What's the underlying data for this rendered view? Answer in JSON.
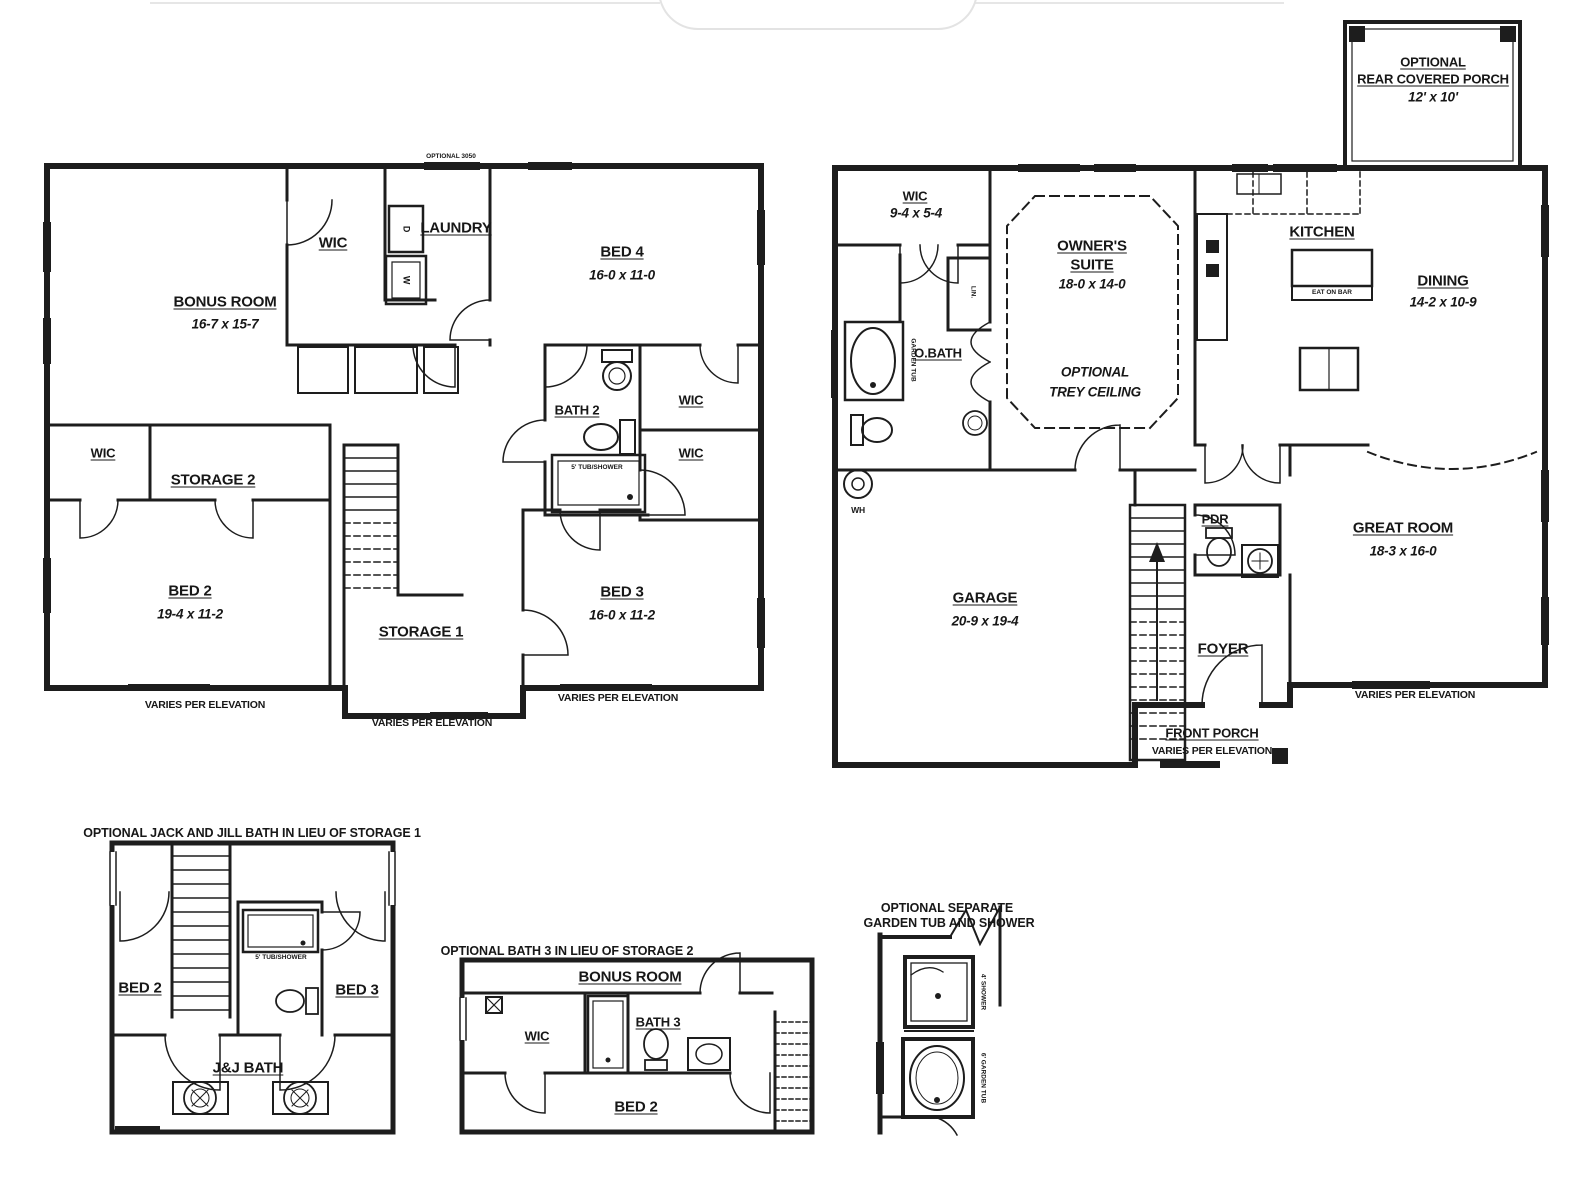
{
  "sf": {
    "opt_note": "OPTIONAL 3050",
    "bonus": "BONUS ROOM",
    "bonus_dim": "16-7 x 15-7",
    "wic": "WIC",
    "laundry": "LAUNDRY",
    "dryer": "D",
    "washer": "W",
    "bed4": "BED 4",
    "bed4_dim": "16-0 x 11-0",
    "bath2": "BATH 2",
    "tub_note": "5' TUB/SHOWER",
    "wic_r1": "WIC",
    "wic_r2": "WIC",
    "wic_l": "WIC",
    "storage2": "STORAGE 2",
    "bed2": "BED 2",
    "bed2_dim": "19-4 x 11-2",
    "storage1": "STORAGE 1",
    "bed3": "BED 3",
    "bed3_dim": "16-0 x 11-2",
    "varies1": "VARIES PER ELEVATION",
    "varies2": "VARIES PER ELEVATION",
    "varies3": "VARIES PER ELEVATION"
  },
  "ff": {
    "porch1": "OPTIONAL",
    "porch2": "REAR COVERED PORCH",
    "porch_dim": "12' x 10'",
    "wic": "WIC",
    "wic_dim": "9-4 x 5-4",
    "obath": "O.BATH",
    "lin": "LIN.",
    "tub_note": "GARDEN TUB",
    "owners1": "OWNER'S",
    "owners2": "SUITE",
    "owners_dim": "18-0 x 14-0",
    "trey1": "OPTIONAL",
    "trey2": "TREY CEILING",
    "kitchen": "KITCHEN",
    "eat_on_bar": "EAT ON BAR",
    "dining": "DINING",
    "dining_dim": "14-2 x 10-9",
    "great": "GREAT ROOM",
    "great_dim": "18-3 x 16-0",
    "garage": "GARAGE",
    "garage_dim": "20-9 x 19-4",
    "wh": "WH",
    "pdr": "PDR",
    "foyer": "FOYER",
    "front_porch": "FRONT PORCH",
    "front_porch_note": "VARIES PER ELEVATION",
    "varies": "VARIES PER ELEVATION"
  },
  "jj": {
    "title": "OPTIONAL JACK AND JILL BATH IN LIEU OF STORAGE 1",
    "bed2": "BED 2",
    "bed3": "BED 3",
    "bath": "J&J BATH",
    "tub_note": "5' TUB/SHOWER"
  },
  "b3": {
    "title": "OPTIONAL BATH 3 IN LIEU OF STORAGE 2",
    "bonus": "BONUS ROOM",
    "wic": "WIC",
    "bath3": "BATH 3",
    "bed2": "BED 2"
  },
  "gt": {
    "title1": "OPTIONAL SEPARATE",
    "title2": "GARDEN TUB AND SHOWER",
    "shower": "4' SHOWER",
    "tub": "6' GARDEN TUB"
  },
  "colors": {
    "ink": "#1d1d1d",
    "paper": "#ffffff",
    "muted": "#e6e6e6"
  }
}
